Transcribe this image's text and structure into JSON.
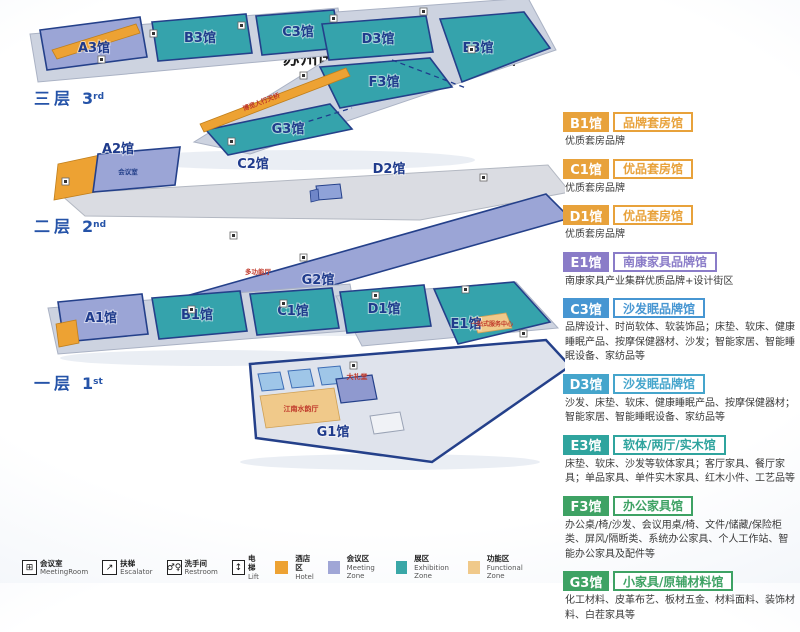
{
  "header": {
    "title": "展览布局",
    "subtitle": "苏州国博 1层+3层 全馆展出"
  },
  "map": {
    "floor3": {
      "label": "三层",
      "num": "3",
      "sup": "rd",
      "halls": [
        "A3馆",
        "B3馆",
        "C3馆",
        "D3馆",
        "E3馆",
        "F3馆",
        "G3馆"
      ],
      "bridge_label": "博览人行天桥"
    },
    "floor2": {
      "label": "二层",
      "num": "2",
      "sup": "nd",
      "halls": [
        "A2馆",
        "C2馆",
        "D2馆",
        "G2馆"
      ],
      "meeting_room": "会议室",
      "multi_hall": "多功能厅"
    },
    "floor1": {
      "label": "一层",
      "num": "1",
      "sup": "st",
      "halls": [
        "A1馆",
        "B1馆",
        "C1馆",
        "D1馆",
        "E1馆",
        "G1馆"
      ],
      "one_stop": "一站式服务中心",
      "auditorium": "大礼堂",
      "jiangnan_hall": "江南水韵厅"
    }
  },
  "hall_legend": [
    {
      "code": "B1馆",
      "name": "品牌套房馆",
      "desc": "优质套房品牌",
      "color": "#E8A23B"
    },
    {
      "code": "C1馆",
      "name": "优品套房馆",
      "desc": "优质套房品牌",
      "color": "#E8A23B"
    },
    {
      "code": "D1馆",
      "name": "优品套房馆",
      "desc": "优质套房品牌",
      "color": "#E8A23B"
    },
    {
      "code": "E1馆",
      "name": "南康家具品牌馆",
      "desc": "南康家具产业集群优质品牌+设计街区",
      "color": "#8A7CC8"
    },
    {
      "code": "C3馆",
      "name": "沙发眠品牌馆",
      "desc": "品牌设计、时尚软体、软装饰品；床垫、软床、健康睡眠产品、按摩保健器材、沙发；智能家居、智能睡眠设备、家纺品等",
      "color": "#4796D2"
    },
    {
      "code": "D3馆",
      "name": "沙发眠品牌馆",
      "desc": "沙发、床垫、软床、健康睡眠产品、按摩保健器材；智能家居、智能睡眠设备、家纺品等",
      "color": "#45A5CC"
    },
    {
      "code": "E3馆",
      "name": "软体/两厅/实木馆",
      "desc": "床垫、软床、沙发等软体家具；客厅家具、餐厅家具；单品家具、单件实木家具、红木小件、工艺品等",
      "color": "#2FA49E"
    },
    {
      "code": "F3馆",
      "name": "办公家具馆",
      "desc": "办公桌/椅/沙发、会议用桌/椅、文件/储藏/保险柜类、屏风/隔断类、系统办公家具、个人工作站、智能办公家具及配件等",
      "color": "#3EA264"
    },
    {
      "code": "G3馆",
      "name": "小家具/原辅材料馆",
      "desc": "化工材料、皮革布艺、板材五金、材料面料、装饰材料、白茬家具等",
      "color": "#3EA264"
    }
  ],
  "facility_legend": [
    {
      "icon": "meeting-room-icon",
      "glyph": "⊞",
      "zh": "会议室",
      "en": "MeetingRoom"
    },
    {
      "icon": "escalator-icon",
      "glyph": "↗",
      "zh": "扶梯",
      "en": "Escalator"
    },
    {
      "icon": "restroom-icon",
      "glyph": "♂♀",
      "zh": "洗手间",
      "en": "Restroom"
    },
    {
      "icon": "lift-icon",
      "glyph": "↕",
      "zh": "电梯",
      "en": "Lift"
    }
  ],
  "zone_legend": [
    {
      "zh": "酒店区",
      "en": "Hotel",
      "color": "#EDA233"
    },
    {
      "zh": "会议区",
      "en": "Meeting Zone",
      "color": "#A0A6D6"
    },
    {
      "zh": "展区",
      "en": "Exhibition Zone",
      "color": "#3AA7A7"
    },
    {
      "zh": "功能区",
      "en": "Functional Zone",
      "color": "#F0C98A"
    }
  ],
  "colors": {
    "title_navy": "#2A3A8C",
    "hall_label_navy": "#1F3B8C",
    "room_label_red": "#c0392b"
  }
}
